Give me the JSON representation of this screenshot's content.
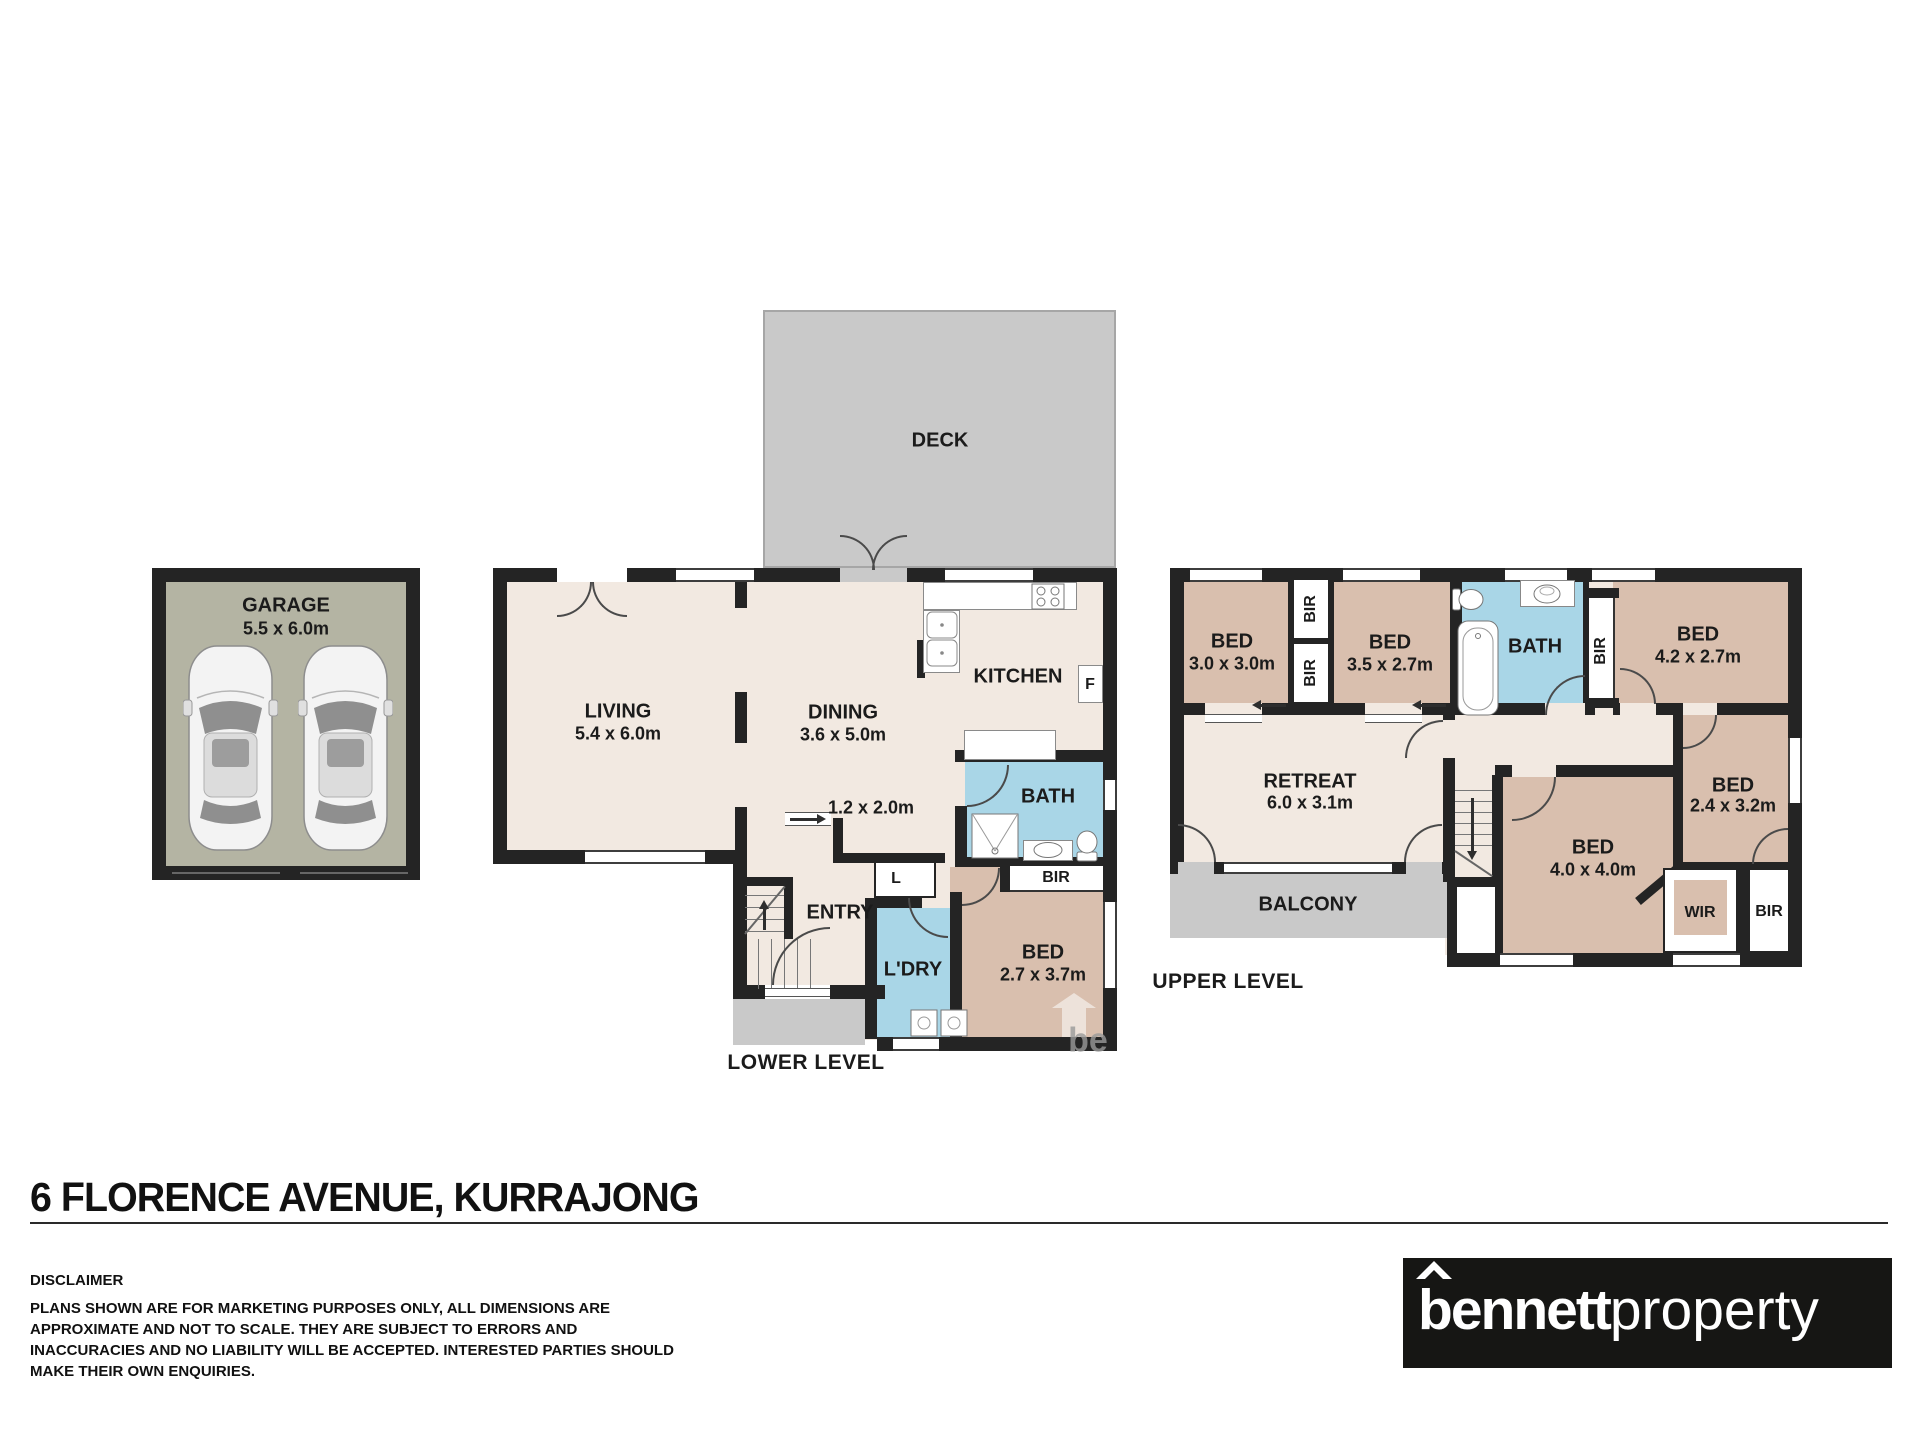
{
  "address": "6 FLORENCE AVENUE, KURRAJONG",
  "levels": {
    "lower": "LOWER LEVEL",
    "upper": "UPPER LEVEL"
  },
  "disclaimer": {
    "heading": "DISCLAIMER",
    "body": "PLANS SHOWN ARE FOR MARKETING PURPOSES ONLY, ALL DIMENSIONS ARE APPROXIMATE AND NOT TO SCALE. THEY ARE SUBJECT TO ERRORS AND INACCURACIES AND NO LIABILITY WILL BE ACCEPTED. INTERESTED PARTIES SHOULD MAKE THEIR OWN ENQUIRIES."
  },
  "logo": {
    "bold": "bennett",
    "light": "property"
  },
  "watermark": "be",
  "rooms": {
    "garage": {
      "name": "GARAGE",
      "dims": "5.5 x 6.0m"
    },
    "deck": {
      "name": "DECK"
    },
    "living": {
      "name": "LIVING",
      "dims": "5.4 x 6.0m"
    },
    "dining": {
      "name": "DINING",
      "dims": "3.6 x 5.0m"
    },
    "kitchen": {
      "name": "KITCHEN"
    },
    "fridge": {
      "name": "F"
    },
    "store": {
      "dims": "1.2 x 2.0m"
    },
    "entry": {
      "name": "ENTRY"
    },
    "linen": {
      "name": "L"
    },
    "laundry": {
      "name": "L'DRY"
    },
    "bath_lower": {
      "name": "BATH"
    },
    "bir_lower": {
      "name": "BIR"
    },
    "bed_lower": {
      "name": "BED",
      "dims": "2.7 x 3.7m"
    },
    "bed_30": {
      "name": "BED",
      "dims": "3.0 x 3.0m"
    },
    "bir_top_a": {
      "name": "BIR"
    },
    "bir_top_b": {
      "name": "BIR"
    },
    "bed_35": {
      "name": "BED",
      "dims": "3.5 x 2.7m"
    },
    "bath_upper": {
      "name": "BATH"
    },
    "bir_bath": {
      "name": "BIR"
    },
    "bed_42": {
      "name": "BED",
      "dims": "4.2 x 2.7m"
    },
    "bed_24": {
      "name": "BED",
      "dims": "2.4 x 3.2m"
    },
    "retreat": {
      "name": "RETREAT",
      "dims": "6.0 x 3.1m"
    },
    "balcony": {
      "name": "BALCONY"
    },
    "bed_40": {
      "name": "BED",
      "dims": "4.0 x 4.0m"
    },
    "wir": {
      "name": "WIR"
    },
    "bir_wir": {
      "name": "BIR"
    }
  },
  "colors": {
    "wall": "#242424",
    "floor_cream": "#f2e9e1",
    "floor_tan": "#d9bfae",
    "floor_blue": "#a9d6e7",
    "deck_grey": "#c9c9c9",
    "garage_olive": "#b4b4a3",
    "logo_black": "#161614",
    "text": "#1b1b1b"
  },
  "fixtures": [
    "car-icon",
    "stove-icon",
    "double-sink-icon",
    "shower-icon",
    "toilet-icon",
    "vanity-icon",
    "bathtub-icon",
    "laundry-appliance-icon",
    "stairs-icon",
    "watermark-arrow-icon"
  ]
}
